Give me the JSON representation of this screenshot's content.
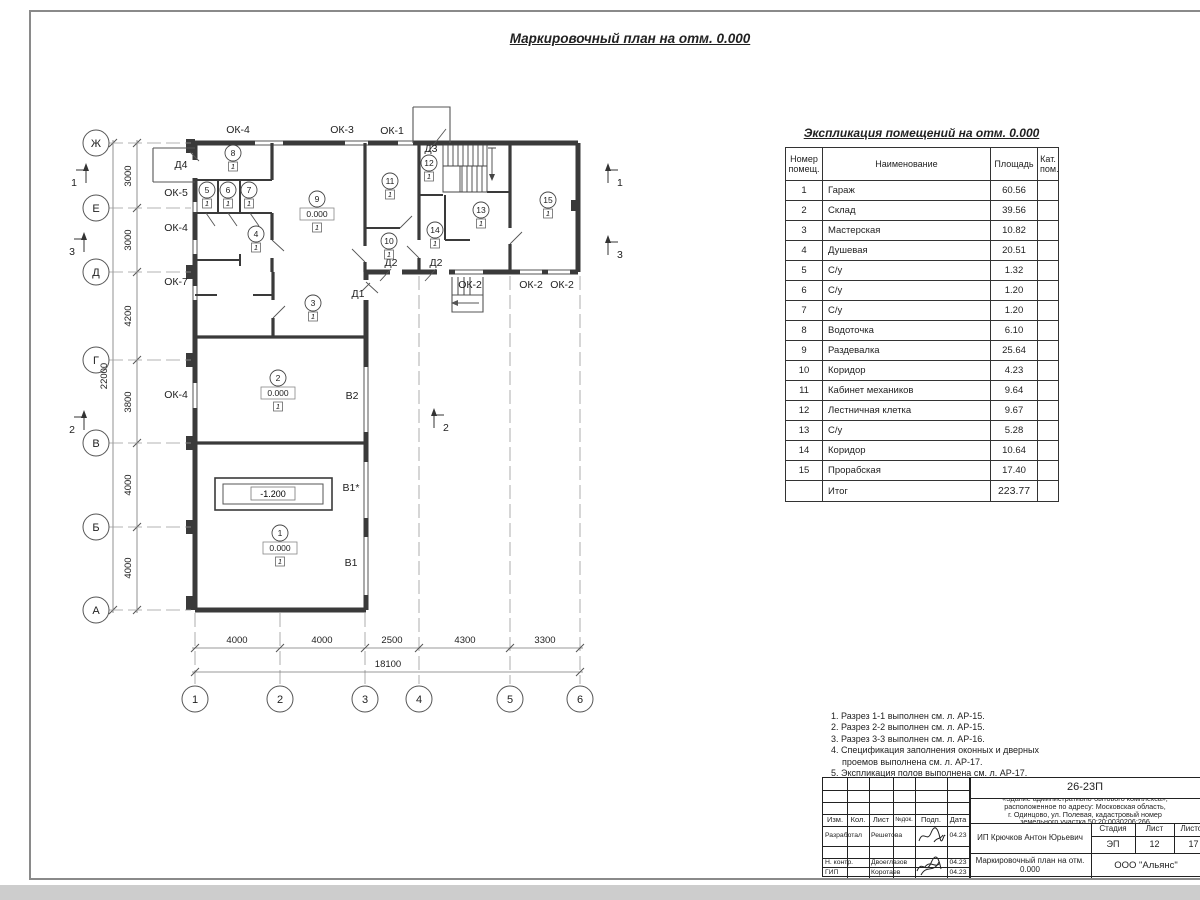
{
  "sheet_title": "Маркировочный план на отм. 0.000",
  "expl_table": {
    "title": "Экспликация помещений на отм. 0.000",
    "header": {
      "num_lines": [
        "Номер",
        "помещ."
      ],
      "name": "Наименование",
      "area": "Площадь",
      "cat_lines": [
        "Кат.",
        "пом."
      ]
    },
    "rows": [
      [
        "1",
        "Гараж",
        "60.56"
      ],
      [
        "2",
        "Склад",
        "39.56"
      ],
      [
        "3",
        "Мастерская",
        "10.82"
      ],
      [
        "4",
        "Душевая",
        "20.51"
      ],
      [
        "5",
        "С/у",
        "1.32"
      ],
      [
        "6",
        "С/у",
        "1.20"
      ],
      [
        "7",
        "С/у",
        "1.20"
      ],
      [
        "8",
        "Водоточка",
        "6.10"
      ],
      [
        "9",
        "Раздевалка",
        "25.64"
      ],
      [
        "10",
        "Коридор",
        "4.23"
      ],
      [
        "11",
        "Кабинет механиков",
        "9.64"
      ],
      [
        "12",
        "Лестничная клетка",
        "9.67"
      ],
      [
        "13",
        "С/у",
        "5.28"
      ],
      [
        "14",
        "Коридор",
        "10.64"
      ],
      [
        "15",
        "Прорабская",
        "17.40"
      ]
    ],
    "total_label": "Итог",
    "total_value": "223.77"
  },
  "notes": [
    "1. Разрез 1-1 выполнен см. л. АР-15.",
    "2. Разрез 2-2 выполнен см. л. АР-15.",
    "3. Разрез 3-3 выполнен см. л. АР-16.",
    "4. Спецификация заполнения оконных и дверных",
    "проемов выполнена см. л. АР-17.",
    "5. Экспликация полов выполнена см. л. АР-17."
  ],
  "stamp": {
    "code": "26-23П",
    "object_lines": [
      "«Здание административно-бытового комплекса»,",
      "расположенное по адресу: Московская область,",
      "г. Одинцово, ул. Полевая, кадастровый номер",
      "земельного участка 50:20:0030206:266"
    ],
    "client": "ИП Крючков Антон Юрьевич",
    "doc_title": "Маркировочный план на отм. 0.000",
    "org": "ООО \"Альянс\"",
    "cols": [
      "Изм.",
      "Кол.",
      "Лист",
      "№док.",
      "Подп.",
      "Дата"
    ],
    "stage_label": "Стадия",
    "sheet_label": "Лист",
    "sheets_label": "Листов",
    "stage": "ЭП",
    "sheet": "12",
    "sheets": "17",
    "rows": [
      {
        "role": "Разработал",
        "name": "Решетова",
        "date": "04.23"
      },
      {
        "role": "Н. контр.",
        "name": "Двоеглазов",
        "date": "04.23"
      },
      {
        "role": "ГИП",
        "name": "Коротаев",
        "date": "04.23"
      }
    ]
  },
  "plan": {
    "h_axes": [
      [
        "Ж",
        143
      ],
      [
        "Е",
        208
      ],
      [
        "Д",
        272
      ],
      [
        "Г",
        360
      ],
      [
        "В",
        443
      ],
      [
        "Б",
        527
      ],
      [
        "А",
        610
      ]
    ],
    "v_axes": [
      [
        "1",
        195
      ],
      [
        "2",
        280
      ],
      [
        "3",
        365
      ],
      [
        "4",
        419
      ],
      [
        "5",
        510
      ],
      [
        "6",
        580
      ]
    ],
    "left_dims": [
      [
        "3000",
        176
      ],
      [
        "3000",
        240
      ],
      [
        "4200",
        316
      ],
      [
        "3800",
        402
      ],
      [
        "4000",
        485
      ],
      [
        "4000",
        568
      ]
    ],
    "left_total": "22000",
    "bottom_dims": [
      [
        "4000",
        237
      ],
      [
        "4000",
        322
      ],
      [
        "2500",
        392
      ],
      [
        "4300",
        465
      ],
      [
        "3300",
        545
      ]
    ],
    "bottom_total": "18100",
    "sections": [
      {
        "label": "1",
        "x": 86,
        "y": 183,
        "side": "left"
      },
      {
        "label": "3",
        "x": 84,
        "y": 252,
        "side": "left"
      },
      {
        "label": "2",
        "x": 84,
        "y": 430,
        "side": "left"
      },
      {
        "label": "1",
        "x": 608,
        "y": 183,
        "side": "right"
      },
      {
        "label": "3",
        "x": 608,
        "y": 255,
        "side": "right"
      },
      {
        "label": "2",
        "x": 434,
        "y": 428,
        "side": "right"
      }
    ],
    "openings": [
      [
        "ОК-4",
        238,
        133
      ],
      [
        "ОК-3",
        342,
        133
      ],
      [
        "ОК-1",
        392,
        134
      ],
      [
        "Д3",
        431,
        152
      ],
      [
        "Д4",
        181,
        168
      ],
      [
        "ОК-5",
        176,
        196
      ],
      [
        "ОК-4",
        176,
        231
      ],
      [
        "ОК-7",
        176,
        285
      ],
      [
        "ОК-4",
        176,
        398
      ],
      [
        "Д2",
        391,
        266
      ],
      [
        "Д2",
        436,
        266
      ],
      [
        "Д1",
        358,
        297
      ],
      [
        "ОК-2",
        470,
        288
      ],
      [
        "ОК-2",
        531,
        288
      ],
      [
        "ОК-2",
        562,
        288
      ],
      [
        "В2",
        352,
        399
      ],
      [
        "В1*",
        351,
        491
      ],
      [
        "В1",
        351,
        566
      ]
    ],
    "rooms": [
      {
        "num": "1",
        "x": 280,
        "y": 533,
        "level": "0.000"
      },
      {
        "num": "2",
        "x": 278,
        "y": 378,
        "level": "0.000"
      },
      {
        "num": "3",
        "x": 313,
        "y": 303
      },
      {
        "num": "4",
        "x": 256,
        "y": 234
      },
      {
        "num": "5",
        "x": 207,
        "y": 190
      },
      {
        "num": "6",
        "x": 228,
        "y": 190
      },
      {
        "num": "7",
        "x": 249,
        "y": 190
      },
      {
        "num": "8",
        "x": 233,
        "y": 153
      },
      {
        "num": "9",
        "x": 317,
        "y": 199,
        "level": "0.000"
      },
      {
        "num": "10",
        "x": 389,
        "y": 241
      },
      {
        "num": "11",
        "x": 390,
        "y": 181
      },
      {
        "num": "12",
        "x": 429,
        "y": 163
      },
      {
        "num": "13",
        "x": 481,
        "y": 210
      },
      {
        "num": "14",
        "x": 435,
        "y": 230
      },
      {
        "num": "15",
        "x": 548,
        "y": 200
      }
    ],
    "floor_mark": "1",
    "pit_level": "-1.200"
  }
}
